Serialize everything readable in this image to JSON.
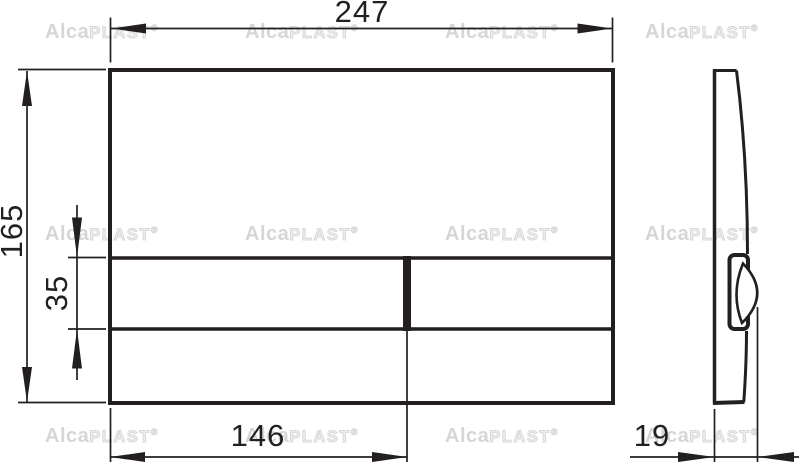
{
  "drawing": {
    "description": "flush-plate technical drawing, front and side view",
    "dimensions": {
      "overall_width_mm": "247",
      "overall_height_mm": "165",
      "button_row_height_mm": "35",
      "button_width_mm": "146",
      "thickness_mm": "19"
    },
    "watermark": {
      "part_bold": "Alca",
      "part_outline": "PLAST",
      "registered_mark": "®"
    },
    "colors": {
      "line": "#231f20",
      "watermark_gray": "#d6d6d6",
      "background": "#ffffff"
    }
  }
}
